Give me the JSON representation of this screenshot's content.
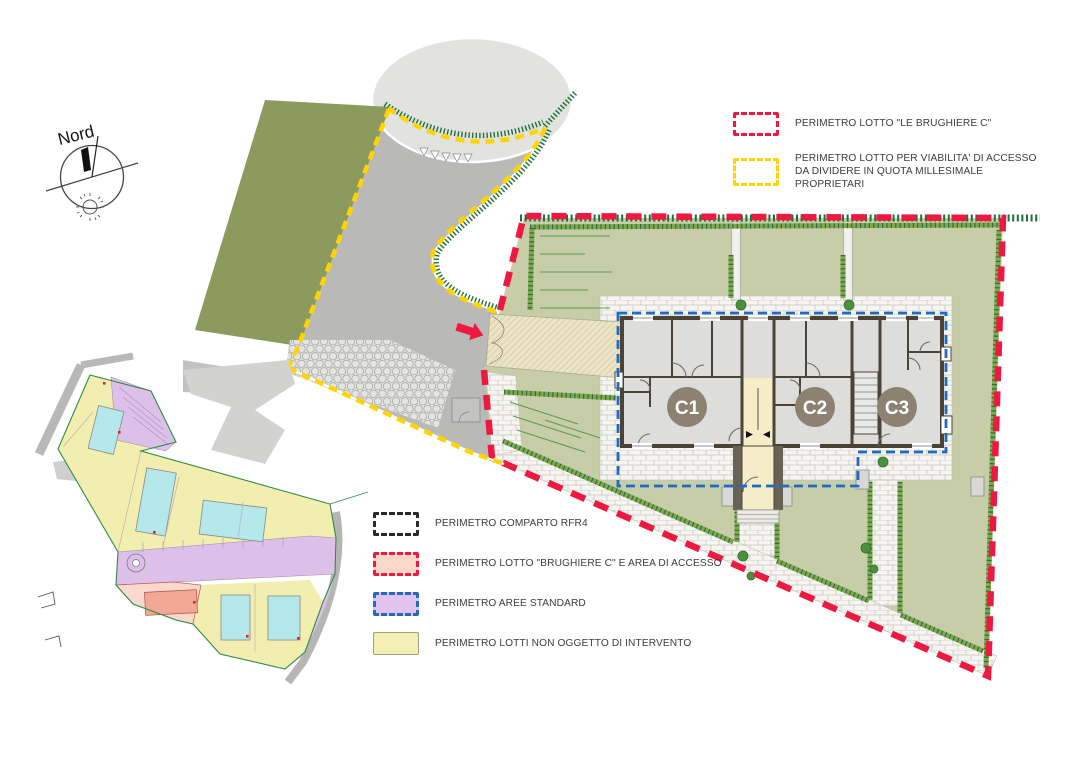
{
  "compass": {
    "label": "Nord"
  },
  "legend_top": {
    "items": [
      {
        "id": "lot-perimeter",
        "label": "PERIMETRO LOTTO \"LE BRUGHIERE C\""
      },
      {
        "id": "viability-perimeter",
        "label": "PERIMETRO LOTTO PER VIABILITA' DI ACCESSO DA DIVIDERE IN QUOTA MILLESIMALE PROPRIETARI"
      }
    ]
  },
  "legend_bottom": {
    "items": [
      {
        "id": "comparto",
        "label": "PERIMETRO COMPARTO RFR4"
      },
      {
        "id": "lotto-brughiere",
        "label": "PERIMETRO LOTTO \"BRUGHIERE C\" E AREA DI ACCESSO"
      },
      {
        "id": "aree-standard",
        "label": "PERIMETRO AREE STANDARD"
      },
      {
        "id": "lotti-non-intervento",
        "label": "PERIMETRO LOTTI NON OGGETTO DI INTERVENTO"
      }
    ]
  },
  "plan": {
    "units": [
      {
        "label": "C1"
      },
      {
        "label": "C2"
      },
      {
        "label": "C3"
      }
    ]
  },
  "colors": {
    "lot_perimeter_red": "#ed1941",
    "viability_yellow": "#ffd400",
    "standard_area_blue": "#1f6cbe",
    "comparto_black": "#2a2a2a",
    "lawn_green": "#c6cda7",
    "hedge_green": "#6fa04c",
    "hedge_dark_green": "#2f6e35",
    "field_olive": "#8d9a5e",
    "road_gray": "#b9b9b8",
    "unit_badge_brown": "#8d8272",
    "legend_pink_fill": "#fbd8c7",
    "legend_purple_fill": "#e3c4ee",
    "legend_yellow_fill": "#f3efb4",
    "inset_yellow": "#f2eeb0",
    "inset_purple": "#dcc0e9",
    "inset_cyan": "#b4e8ea",
    "inset_pink": "#f9d9cd",
    "inset_salmon": "#f3a795"
  }
}
